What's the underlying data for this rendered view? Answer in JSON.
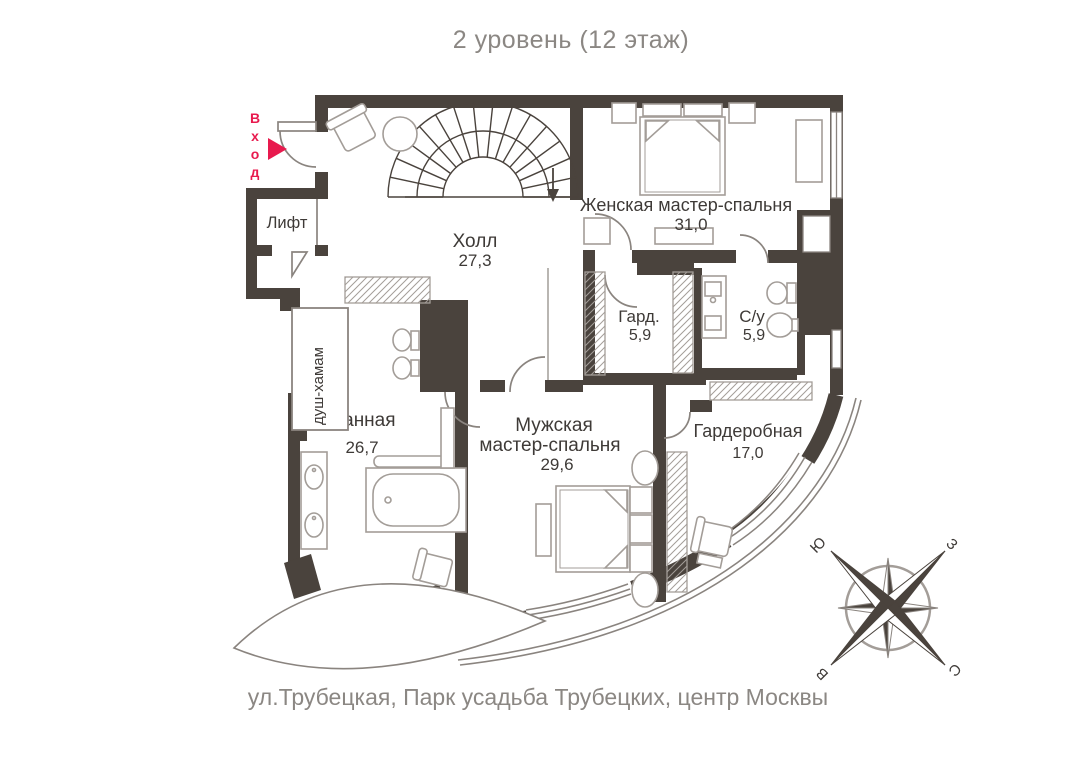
{
  "title": "2 уровень (12 этаж)",
  "caption": "ул.Трубецкая, Парк усадьба Трубецких, центр Москвы",
  "entrance": {
    "label": "Вход"
  },
  "colors": {
    "wall": "#4a433d",
    "furniture": "#a39d98",
    "accent": "#e81a4e",
    "muted_text": "#8b8783",
    "label_text": "#3e3a37"
  },
  "rooms": {
    "lift": {
      "name": "Лифт"
    },
    "hall": {
      "name": "Холл",
      "area": "27,3"
    },
    "female_bedroom": {
      "name": "Женская мастер-спальня",
      "area": "31,0"
    },
    "wardrobe": {
      "name": "Гард.",
      "area": "5,9"
    },
    "wc": {
      "name": "С/у",
      "area": "5,9"
    },
    "hammam": {
      "name": "душ-хамам"
    },
    "bathroom": {
      "name": "Ванная",
      "area": "26,7"
    },
    "male_bedroom": {
      "name_line1": "Мужская",
      "name_line2": "мастер-спальня",
      "area": "29,6"
    },
    "dressing": {
      "name": "Гардеробная",
      "area": "17,0"
    }
  },
  "compass": {
    "north": "С",
    "south": "Ю",
    "west": "З",
    "east": "В"
  }
}
